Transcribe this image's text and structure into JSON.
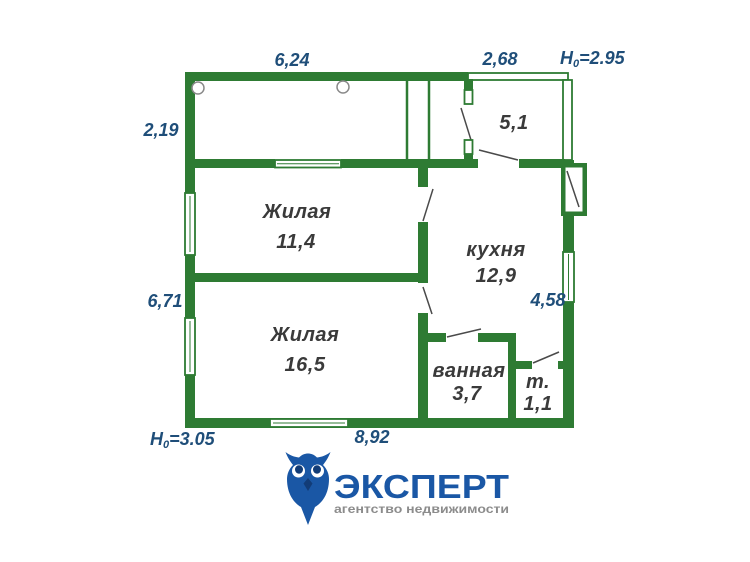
{
  "colors": {
    "background": "#ffffff",
    "wall": "#2e7b33",
    "dim_text": "#1f4e79",
    "room_text": "#3a3a3a",
    "door_line": "#4a4a4a",
    "symbol_gray": "#8a8a8a",
    "logo_blue": "#1a57a5",
    "logo_dark_blue": "#123c77",
    "logo_gray": "#8c8c8c"
  },
  "plan": {
    "rooms": [
      {
        "label": "Жилая",
        "area": "11,4"
      },
      {
        "label": "Жилая",
        "area": "16,5"
      },
      {
        "label": "кухня",
        "area": "12,9"
      },
      {
        "label": "ванная",
        "area": "3,7"
      },
      {
        "label": "т.",
        "area": "1,1"
      },
      {
        "label": "",
        "area": "5,1"
      }
    ],
    "dimensions": {
      "top": "6,24",
      "top_right": "2,68",
      "left_upper": "2,19",
      "left_lower": "6,71",
      "right": "4,58",
      "bottom": "8,92",
      "height_top": {
        "prefix": "H",
        "sub": "0",
        "value": "=2.95"
      },
      "height_bottom": {
        "prefix": "H",
        "sub": "0",
        "value": "=3.05"
      }
    }
  },
  "logo": {
    "title": "ЭКСПЕРТ",
    "subtitle": "агентство недвижимости",
    "icon": "owl-icon"
  }
}
